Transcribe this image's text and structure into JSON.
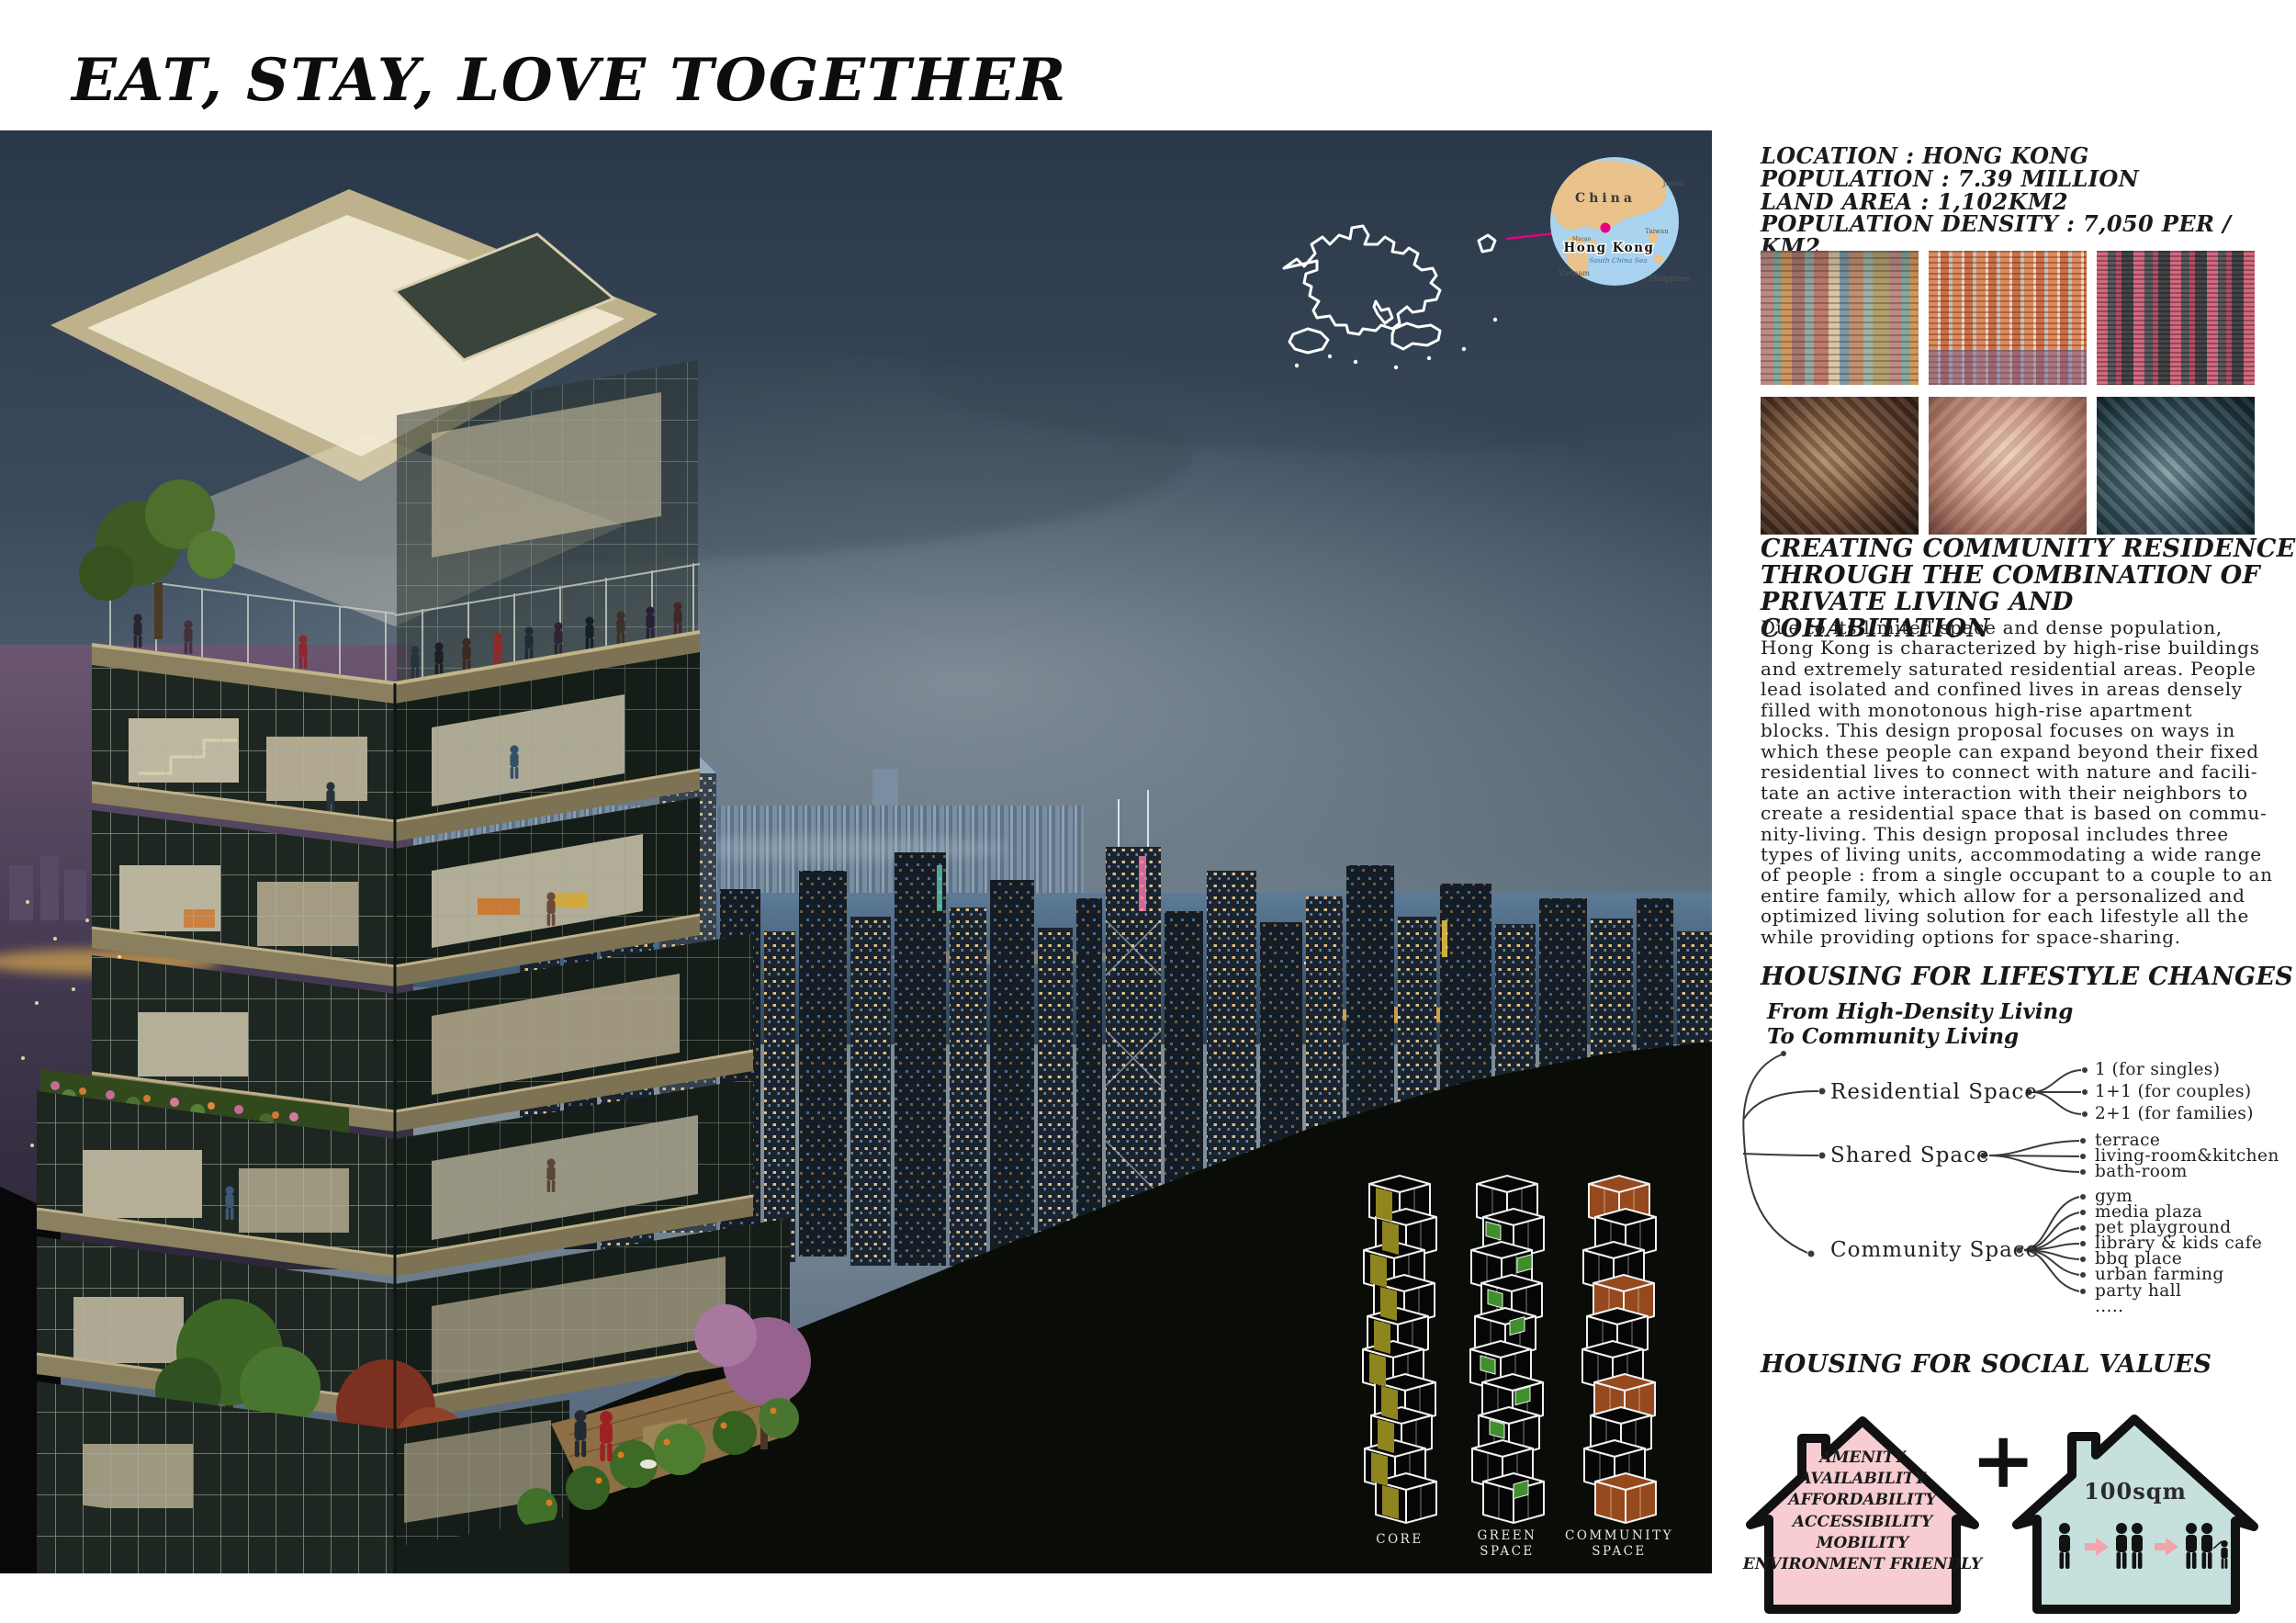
{
  "title": "EAT, STAY, LOVE TOGETHER",
  "stats": {
    "lines": "LOCATION : HONG KONG\nPOPULATION : 7.39 MILLION\nLAND AREA : 1,102KM2\nPOPULATION DENSITY : 7,050 PER / KM2"
  },
  "map": {
    "accent_color": "#e6007e",
    "globe_labels": {
      "china": "China",
      "japan": "Japan",
      "taiwan": "Taiwan",
      "hong_kong": "Hong Kong",
      "vietnam": "Vietnam",
      "philippines": "Philippines",
      "sea": "South China Sea",
      "macao": "Macao"
    }
  },
  "photos": {
    "descriptions": [
      "dense colorful high-rise facades",
      "orange striped apartment tower facade",
      "pink and grey apartment tower facade",
      "overhead view of cramped flat (brown)",
      "overhead view of cramped flat with residents",
      "overhead view of cramped flat (dark kitchen)"
    ]
  },
  "intro": {
    "heading": "CREATING COMMUNITY RESIDENCE\nTHROUGH THE COMBINATION OF\nPRIVATE LIVING AND COHABITATION",
    "body": "Due to its limited space and dense population,\nHong Kong is characterized by high-rise buildings\nand extremely saturated residential areas. People\nlead isolated and confined lives in areas densely\nfilled with monotonous high-rise apartment\nblocks. This design proposal focuses on ways in\nwhich these people can expand beyond their fixed\nresidential lives to connect with nature and facili-\ntate an active interaction with their neighbors to\ncreate a residential space that is based on commu-\nnity-living. This design proposal includes three\ntypes of living units, accommodating a wide range\nof people : from a single occupant to a couple to an\nentire family, which allow for a personalized and\noptimized living solution for each lifestyle all the\nwhile providing options for space-sharing."
  },
  "lifestyle": {
    "heading": "HOUSING FOR LIFESTYLE CHANGES",
    "root": "From High-Density Living\nTo Community Living",
    "branches": [
      {
        "label": "Residential Space",
        "items": [
          "1 (for singles)",
          "1+1 (for couples)",
          "2+1 (for families)"
        ]
      },
      {
        "label": "Shared Space",
        "items": [
          "terrace",
          "living-room&kitchen",
          "bath-room"
        ]
      },
      {
        "label": "Community Space",
        "items": [
          "gym",
          "media plaza",
          "pet playground",
          "library & kids cafe",
          "bbq place",
          "urban farming",
          "party hall",
          "....."
        ]
      }
    ]
  },
  "social": {
    "heading": "HOUSING FOR SOCIAL VALUES",
    "values": [
      "AMENITY",
      "AVAILABILITY",
      "AFFORDABILITY",
      "ACCESSIBILITY",
      "MOBILITY",
      "ENVIRONMENT FRIENDLY"
    ],
    "plus": "+",
    "area_label": "100sqm",
    "pink": "#f7cdd1",
    "teal": "#c5e0dd",
    "arrow_pink": "#f2a4ad"
  },
  "towers": [
    {
      "label": "CORE",
      "lines": [
        "CORE"
      ],
      "color": "#8f851f"
    },
    {
      "label": "GREEN SPACE",
      "lines": [
        "GREEN",
        "SPACE"
      ],
      "color": "#3f8f2c"
    },
    {
      "label": "COMMUNITY SPACE",
      "lines": [
        "COMMUNITY",
        "SPACE"
      ],
      "color": "#96491d"
    }
  ]
}
